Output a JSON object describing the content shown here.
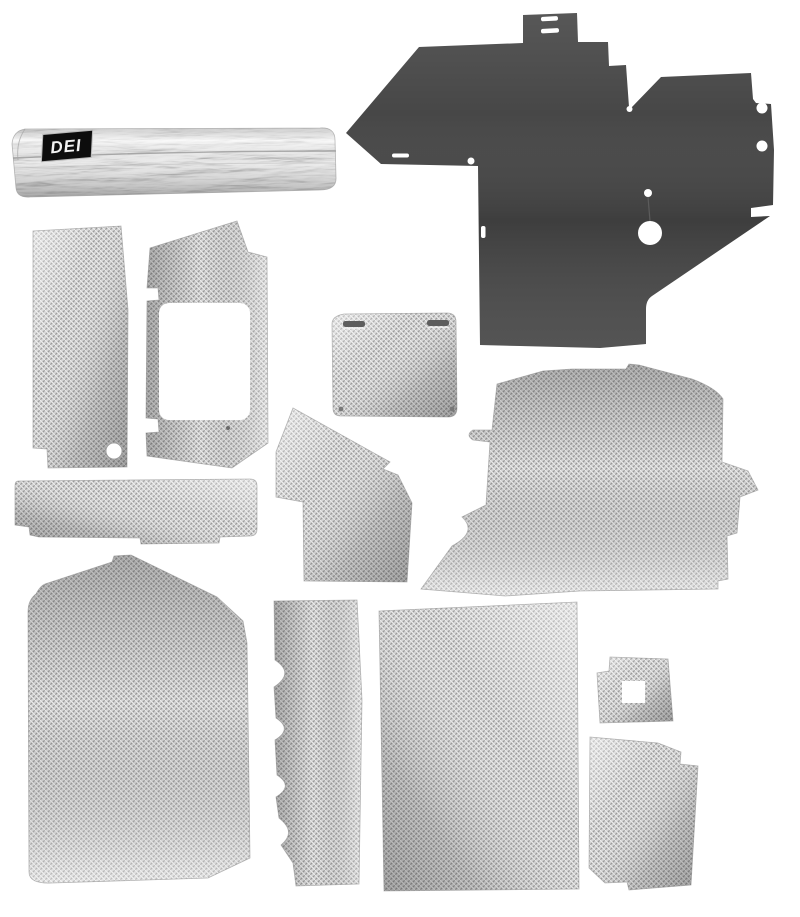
{
  "image": {
    "type": "product-photo",
    "description": "DEI heat shield / insulation kit: thirteen die-cut panels on a white background — one dark firewall panel, eleven silver woven-mesh heat-shield panels of various shapes, and one rolled foil heat barrier with a black DEI logo label.",
    "background_color": "#ffffff"
  },
  "brand": {
    "label": "DEI",
    "label_bg": "#0d0d0d",
    "label_text_color": "#f2f2f2"
  },
  "colors": {
    "dark_panel": "#474747",
    "mesh_base": "#d4d4d4",
    "mesh_dark": "#989898",
    "mesh_light": "#eeeeee",
    "foil": "#e9e9e9",
    "hole": "#ffffff"
  },
  "pieces": [
    {
      "name": "foil-roll",
      "description": "Rolled aluminized heat barrier with black DEI label"
    },
    {
      "name": "firewall-panel-dark",
      "description": "Large dark irregular firewall panel with top tab, slots, notches and round holes"
    },
    {
      "name": "tall-side-panel",
      "description": "Tall rectangular mesh panel with bottom-left step and round hole"
    },
    {
      "name": "window-cutout-panel",
      "description": "Mesh panel with large rounded rectangular window cutout and two edge notches"
    },
    {
      "name": "slotted-square-panel",
      "description": "Rounded square mesh panel with two slots near top edge"
    },
    {
      "name": "long-sill-strip",
      "description": "Long horizontal mesh strip with stepped bottom edge"
    },
    {
      "name": "angled-center-panel",
      "description": "Irregular peaked mesh panel with side notches"
    },
    {
      "name": "large-floor-panel-right",
      "description": "Large mesh floor panel with right-side pointed tab and notched left edge"
    },
    {
      "name": "large-floor-panel-left",
      "description": "Large tapered mesh floor panel with peaked top-right corner"
    },
    {
      "name": "scalloped-edge-strip",
      "description": "Narrow vertical mesh strip with scalloped left edge"
    },
    {
      "name": "large-rectangle-panel",
      "description": "Large nearly rectangular mesh panel"
    },
    {
      "name": "small-square-grommet-panel",
      "description": "Small square mesh panel with square center hole"
    },
    {
      "name": "curved-corner-panel",
      "description": "Small mesh panel with stepped right shoulder"
    }
  ]
}
